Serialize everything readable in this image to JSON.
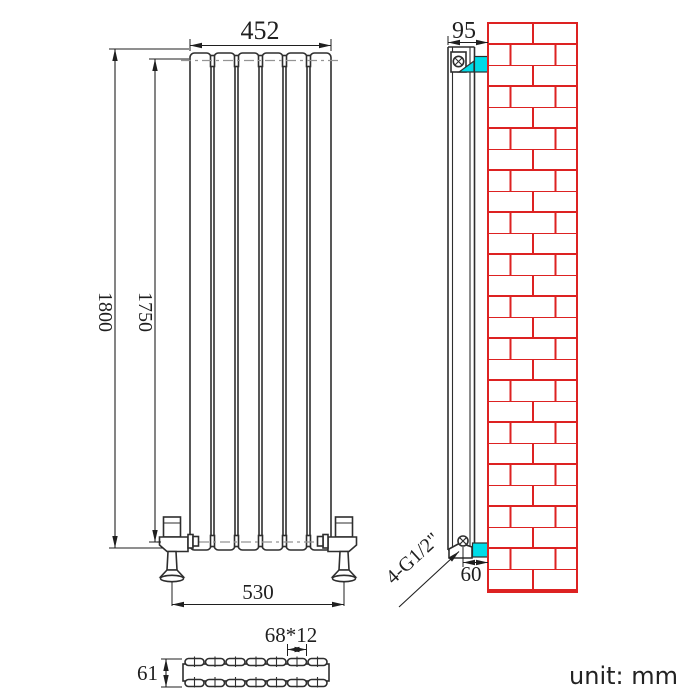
{
  "colors": {
    "bg": "#ffffff",
    "line": "#2e2e2e",
    "dim": "#1f1f1f",
    "dash": "#949494",
    "brick": "#dd2222",
    "bracket": "#00dce8"
  },
  "drawing": {
    "unit_label": "unit: mm",
    "front_view": {
      "panel_count": 6,
      "dim_width": "452",
      "dim_height": "1800",
      "dim_height_inner": "1750",
      "dim_valve_span": "530"
    },
    "side_view": {
      "dim_depth": "95",
      "dim_wall_offset": "60",
      "connection_label": "4-G1/2\""
    },
    "top_view": {
      "dim_tube": "68*12",
      "dim_depth": "61"
    }
  }
}
